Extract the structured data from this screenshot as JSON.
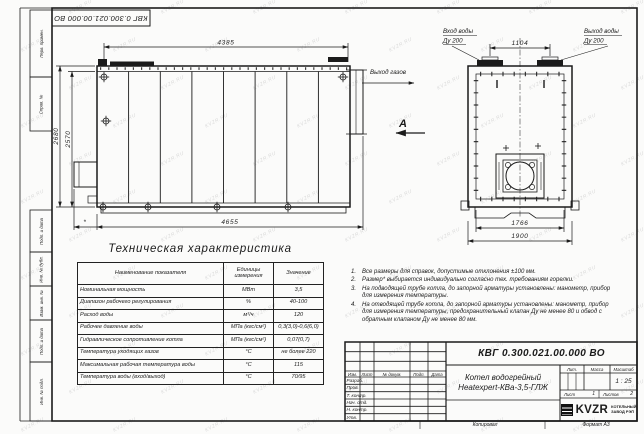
{
  "sheet": {
    "doc_number": "КВГ 0.300.021.00.000 ВО",
    "watermark": "KVZR.RU",
    "copied_label": "Копировал",
    "format_label": "Формат А3"
  },
  "frame": {
    "left_labels": [
      "Перв. примен.",
      "Справ. №",
      "Подп. и дата",
      "Инв. № дубл.",
      "Взам. инв. №",
      "Подп. и дата",
      "Инв. № подл."
    ]
  },
  "side_view": {
    "dim_top": "4385",
    "dim_height_outer": "2680",
    "dim_height_inner": "2570",
    "dim_bottom": "4655",
    "dim_star": "*",
    "gas_outlet": "Выход газов",
    "view_label": "А"
  },
  "end_view": {
    "water_inlet_line1": "Вход воды",
    "water_inlet_line2": "Ду 200",
    "water_outlet_line1": "Выход воды",
    "water_outlet_line2": "Ду 200",
    "dim_nozzle_spacing": "1104",
    "dim_width_inner": "1766",
    "dim_width_outer": "1900"
  },
  "spec_table": {
    "title": "Техническая характеристика",
    "headers": [
      "Наименование показателя",
      "Единицы измерения",
      "Значение"
    ],
    "rows": [
      {
        "name": "Номинальная мощность",
        "units": "МВт",
        "value": "3,5"
      },
      {
        "name": "Диапазон рабочего регулирования",
        "units": "%",
        "value": "40-100"
      },
      {
        "name": "Расход воды",
        "units": "м³/ч",
        "value": "120"
      },
      {
        "name": "Рабочее давление воды",
        "units": "МПа (кгс/см²)",
        "value": "0,3(3,0)-0,6(6,0)"
      },
      {
        "name": "Гидравлическое сопротивление котла",
        "units": "МПа (кгс/см²)",
        "value": "0,07(0,7)"
      },
      {
        "name": "Температура уходящих газов",
        "units": "°С",
        "value": "не более 220"
      },
      {
        "name": "Максимальная рабочая температура воды",
        "units": "°С",
        "value": "115"
      },
      {
        "name": "Температура воды (вход/выход)",
        "units": "°С",
        "value": "70/95"
      }
    ]
  },
  "notes": [
    {
      "num": "1.",
      "text": "Все размеры для справок, допустимые отклонения ±100 мм."
    },
    {
      "num": "2.",
      "text": "Размер* выбирается индивидуально согласно тех. требованиям горелки."
    },
    {
      "num": "3.",
      "text": "На подводящей трубе котла, до запорной арматуры установлены: манометр, прибор для измерения температуры."
    },
    {
      "num": "4.",
      "text": "На отводящей трубе котла, до запорной арматуры установлены: манометр, прибор для измерения температуры, предохранительный клапан Ду не менее 80 и обвод с обратным клапаном Ду не менее 80 мм."
    }
  ],
  "title_block": {
    "doc_number": "КВГ 0.300.021.00.000 ВО",
    "header_cols": [
      "Изм.",
      "Лист",
      "№ докум.",
      "Подп.",
      "Дата"
    ],
    "sign_rows": [
      "Разраб.",
      "Пров.",
      "Т. контр.",
      "Нач. отд.",
      "Н. контр.",
      "Утв."
    ],
    "name_line1": "Котел водогрейный",
    "name_line2": "Heatexpert-КВа-3,5-ГЛЖ",
    "lit_label": "Лит.",
    "mass_label": "Масса",
    "scale_label": "Масштаб",
    "scale_value": "1 : 25",
    "sheet_label": "Лист",
    "sheet_value": "1",
    "sheets_label": "Листов",
    "sheets_value": "2",
    "logo_text": "KVZR",
    "logo_sub1": "КОТЕЛЬНЫЙ",
    "logo_sub2": "ЗАВОД РЭП"
  }
}
